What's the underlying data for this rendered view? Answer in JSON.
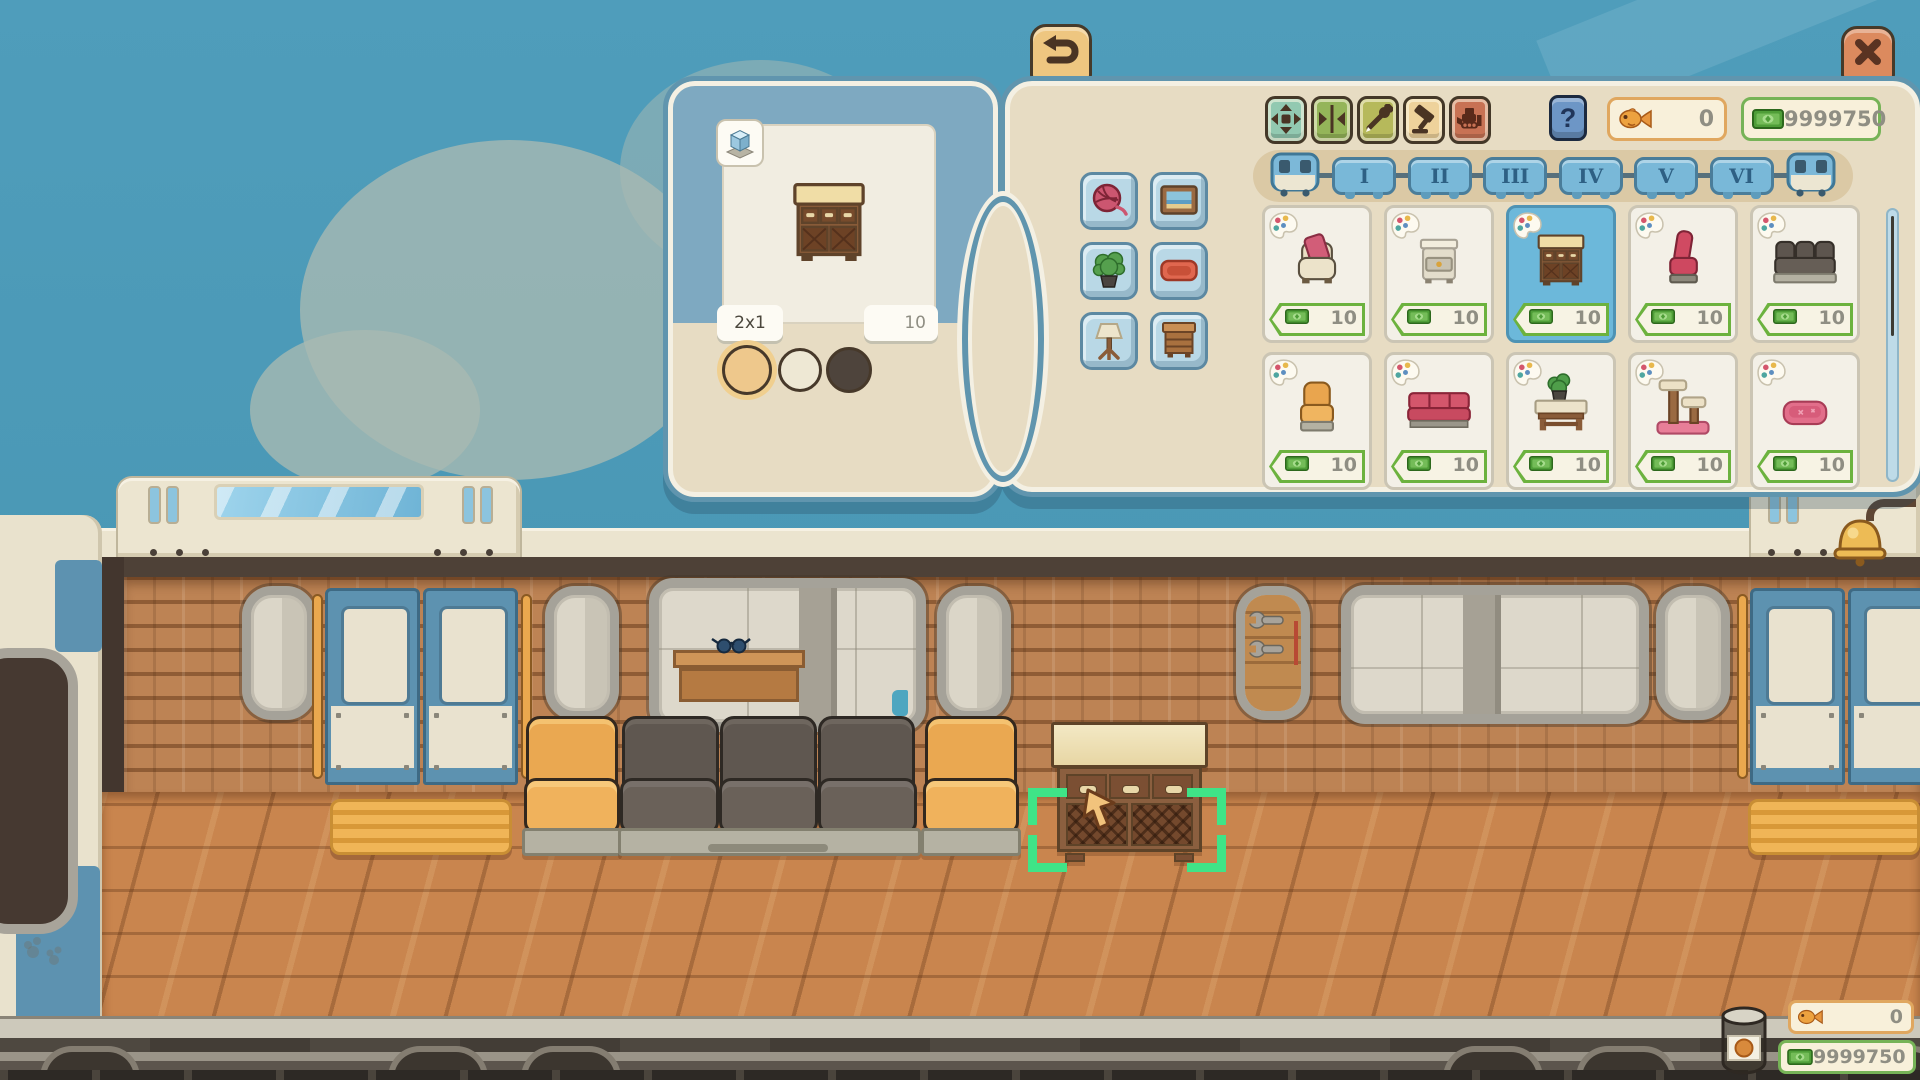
{
  "colors": {
    "sky": "#4f9dbb",
    "panel_tan": "#e7dcc3",
    "panel_border": "#6095ae",
    "selection_green": "#3fe487",
    "fish_border": "#e0a75f",
    "money_border": "#76b357",
    "counter_text": "#8f8e83",
    "selected_card": "#6cb8da"
  },
  "hud": {
    "back_button": {
      "icon": "back-arrow-icon"
    },
    "close_button": {
      "icon": "close-x-icon"
    },
    "help_button": {
      "label": "?"
    },
    "fish_counter": {
      "icon": "goldfish-icon",
      "value": "0"
    },
    "money_counter": {
      "icon": "money-bill-icon",
      "value": "9999750"
    },
    "bottom_fish_counter": {
      "icon": "goldfish-icon",
      "value": "0"
    },
    "bottom_money_counter": {
      "icon": "money-bill-icon",
      "value": "9999750"
    },
    "treat_jar_icon": "treat-jar-icon"
  },
  "edit_toolbar": [
    {
      "name": "move-tool",
      "icon": "move-arrows-icon",
      "color": "#92c9b1"
    },
    {
      "name": "flip-tool",
      "icon": "flip-horizontal-icon",
      "color": "#94b559"
    },
    {
      "name": "paint-tool",
      "icon": "eyedropper-icon",
      "color": "#b6b95b"
    },
    {
      "name": "build-tool",
      "icon": "hammer-icon",
      "color": "#eed29b"
    },
    {
      "name": "demolish-tool",
      "icon": "bulldozer-icon",
      "color": "#c87254"
    }
  ],
  "preview_panel": {
    "view_toggle_icon": "isometric-cube-icon",
    "item_sprite": "cabinet",
    "size_label": "2x1",
    "price_label": "10",
    "swatches": [
      {
        "name": "tan",
        "color": "#eec88c",
        "selected": true
      },
      {
        "name": "cream",
        "color": "#eee8d4",
        "selected": false
      },
      {
        "name": "dark-brown",
        "color": "#4e443c",
        "selected": false
      }
    ]
  },
  "categories": [
    {
      "name": "toys",
      "icon": "yarn-ball-icon"
    },
    {
      "name": "wall-decor",
      "icon": "picture-frame-icon"
    },
    {
      "name": "plants",
      "icon": "potted-plant-icon"
    },
    {
      "name": "pet-beds",
      "icon": "pet-bed-icon"
    },
    {
      "name": "lamps",
      "icon": "table-lamp-icon"
    },
    {
      "name": "furniture",
      "icon": "dresser-icon"
    }
  ],
  "train_tabs": {
    "left_locomotive_icon": "locomotive-icon",
    "right_locomotive_icon": "locomotive-icon",
    "cars": [
      {
        "label": "I"
      },
      {
        "label": "II"
      },
      {
        "label": "III"
      },
      {
        "label": "IV"
      },
      {
        "label": "V"
      },
      {
        "label": "VI"
      }
    ]
  },
  "shop_items": [
    {
      "name": "cream armchair with pink cushion",
      "sprite": "armchair-cream",
      "price": "10",
      "selected": false
    },
    {
      "name": "white nightstand",
      "sprite": "nightstand",
      "price": "10",
      "selected": false
    },
    {
      "name": "wooden cabinet",
      "sprite": "cabinet",
      "price": "10",
      "selected": true
    },
    {
      "name": "pink chair",
      "sprite": "chair-pink",
      "price": "10",
      "selected": false
    },
    {
      "name": "gray sofa",
      "sprite": "sofa-gray",
      "price": "10",
      "selected": false
    },
    {
      "name": "orange armchair",
      "sprite": "armchair-orange",
      "price": "10",
      "selected": false
    },
    {
      "name": "red sofa",
      "sprite": "sofa-red",
      "price": "10",
      "selected": false
    },
    {
      "name": "table with plant",
      "sprite": "table-plant",
      "price": "10",
      "selected": false
    },
    {
      "name": "cat tree",
      "sprite": "cat-tree",
      "price": "10",
      "selected": false
    },
    {
      "name": "pink pet bed",
      "sprite": "pet-bed",
      "price": "10",
      "selected": false
    }
  ],
  "scene": {
    "placed_item": {
      "name": "wooden cabinet",
      "selected": true,
      "cursor_icon": "cursor-arrow-icon"
    },
    "seats": [
      "orange armchair",
      "gray sofa",
      "orange armchair"
    ],
    "decor_icons": [
      "bell-icon",
      "wrench-pair-icon",
      "sunglasses-icon",
      "paw-print-icon"
    ]
  }
}
